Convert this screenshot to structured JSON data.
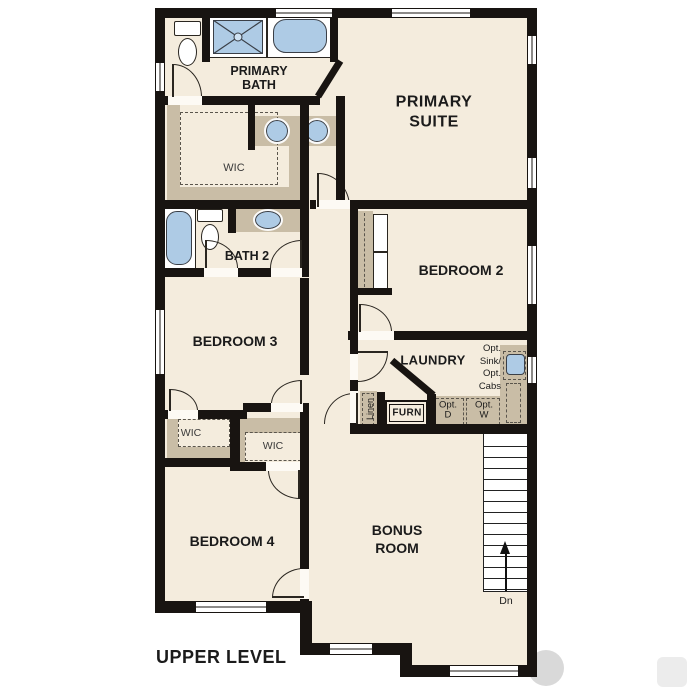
{
  "plan": {
    "title": "UPPER LEVEL",
    "labels": {
      "primary_bath": "PRIMARY\nBATH",
      "primary_suite": "PRIMARY\nSUITE",
      "wic_primary": "WIC",
      "bath2": "BATH 2",
      "bedroom2": "BEDROOM 2",
      "bedroom3": "BEDROOM 3",
      "laundry": "LAUNDRY",
      "opt_sink_cabs": "Opt.\nSink/\nOpt.\nCabs",
      "opt_dryer": "Opt.\nD",
      "opt_washer": "Opt.\nW",
      "furnace": "FURN",
      "linen": "Linen",
      "wic_left": "WIC",
      "wic_right": "WIC",
      "bedroom4": "BEDROOM 4",
      "bonus_room": "BONUS\nROOM",
      "stairs_down": "Dn"
    },
    "colors": {
      "floor": "#f4ecdd",
      "wall": "#181411",
      "case": "#c9bda6",
      "blue": "#aecbe5",
      "ink": "#1b1b1b",
      "page": "#ffffff"
    }
  }
}
